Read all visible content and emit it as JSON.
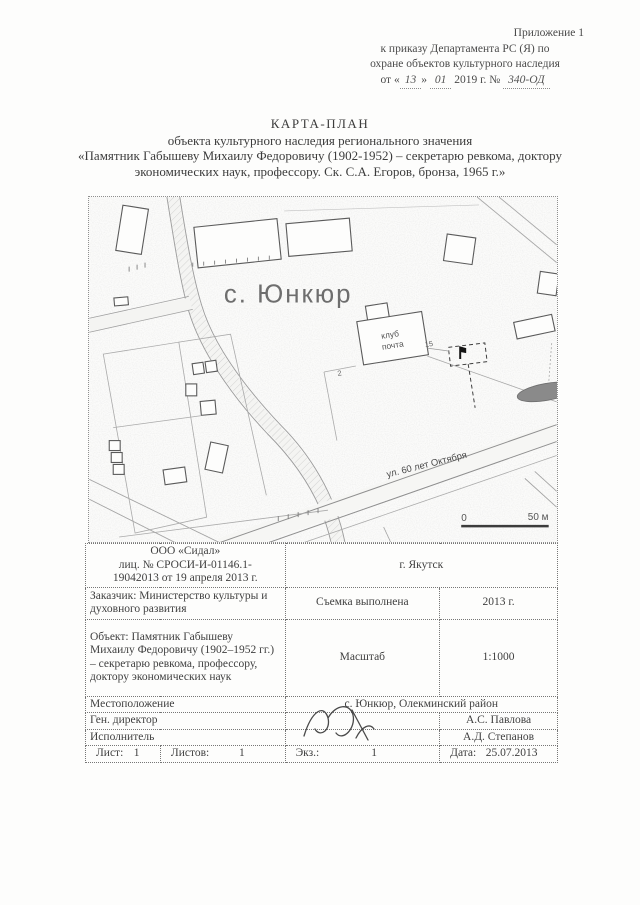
{
  "header": {
    "line1": "Приложение 1",
    "line2": "к приказу Департамента РС (Я) по",
    "line3": "охране объектов культурного наследия",
    "order_pre": "от «",
    "order_day": "13",
    "order_mid": "»",
    "order_month": "01",
    "order_post": "2019 г. №",
    "order_num": "340-ОД"
  },
  "title": {
    "line1": "КАРТА-ПЛАН",
    "line2": "объекта культурного наследия регионального значения",
    "line3": "«Памятник Габышеву Михаилу Федоровичу (1902-1952) – секретарю ревкома, доктору",
    "line4": "экономических наук, профессору. Ск. С.А. Егоров, бронза, 1965 г.»"
  },
  "map": {
    "village_label": "с. Юнкюр",
    "street_label": "ул. 60 лет Октября",
    "club_label": "клуб",
    "post_label": "почта",
    "house_number": "15",
    "parcel_number": "2",
    "scale_start": "0",
    "scale_end": "50 м"
  },
  "table": {
    "org_l1": "ООО «Сидал»",
    "org_l2": "лиц. № СРОСИ-И-01146.1-",
    "org_l3": "19042013 от 19 апреля 2013 г.",
    "city": "г. Якутск",
    "customer": "Заказчик: Министерство культуры и духовного развития",
    "survey_label": "Съемка выполнена",
    "survey_year": "2013 г.",
    "object": "Объект: Памятник Габышеву Михаилу Федоровичу (1902–1952 гг.) – секретарю ревкома, профессору, доктору экономических наук",
    "scale_label": "Масштаб",
    "scale_value": "1:1000",
    "location_label": "Местоположение",
    "location_value": "с. Юнкюр, Олекминский район",
    "director_label": "Ген. директор",
    "director_name": "А.С. Павлова",
    "executor_label": "Исполнитель",
    "executor_name": "А.Д. Степанов",
    "sheet_label": "Лист:",
    "sheet_value": "1",
    "sheets_label": "Листов:",
    "sheets_value": "1",
    "copy_label": "Экз.:",
    "copy_value": "1",
    "date_label": "Дата:",
    "date_value": "25.07.2013"
  },
  "colors": {
    "ink": "#3f3f3f",
    "map_label_gray": "#6e6e6e",
    "pond_gray": "#8a8a8a"
  }
}
